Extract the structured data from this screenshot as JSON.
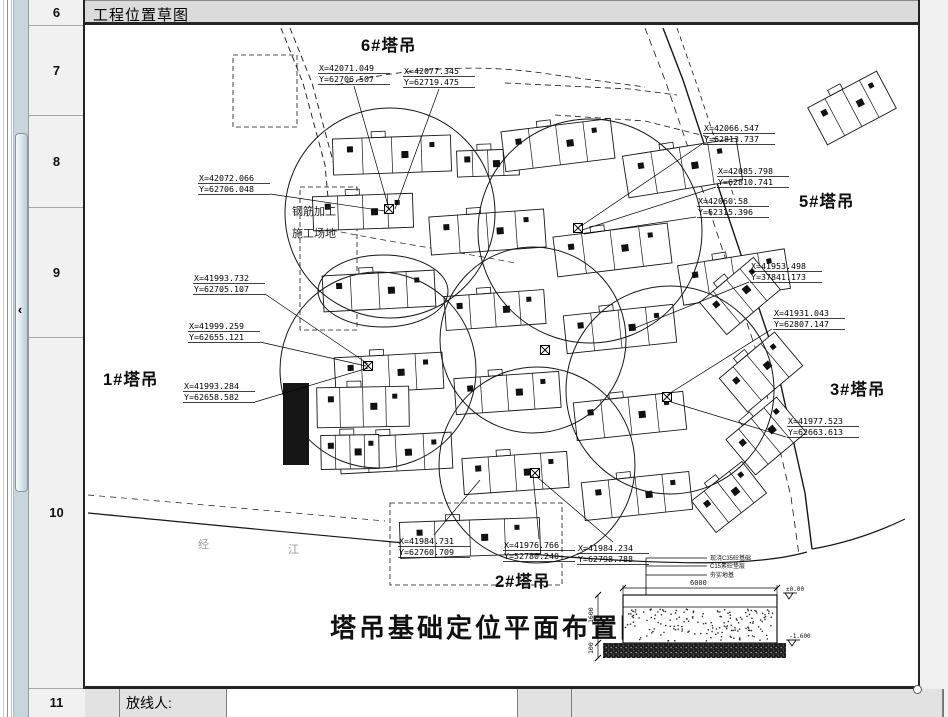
{
  "title_bar": {
    "title": "工程位置草图"
  },
  "row_headers": [
    "6",
    "7",
    "8",
    "9",
    "10",
    "11"
  ],
  "bottom_row": {
    "label": "放线人:"
  },
  "plan": {
    "title": "塔吊基础定位平面布置图",
    "cranes": [
      {
        "name": "6#塔吊",
        "x": 276,
        "y": 26
      },
      {
        "name": "5#塔吊",
        "x": 714,
        "y": 182
      },
      {
        "name": "1#塔吊",
        "x": 18,
        "y": 360
      },
      {
        "name": "3#塔吊",
        "x": 745,
        "y": 370
      },
      {
        "name": "2#塔吊",
        "x": 410,
        "y": 562
      }
    ],
    "callouts": [
      {
        "x": 233,
        "y": 38,
        "l1": "X=42071.049",
        "l2": "Y=62706.507",
        "side": "d",
        "tx": 304,
        "ty": 184
      },
      {
        "x": 318,
        "y": 41,
        "l1": "X=42077.345",
        "l2": "Y=62719.475",
        "side": "d",
        "tx": 310,
        "ty": 184
      },
      {
        "x": 113,
        "y": 148,
        "l1": "X=42072.066",
        "l2": "Y=62706.048",
        "side": "r",
        "tx": 300,
        "ty": 186
      },
      {
        "x": 618,
        "y": 98,
        "l1": "X=42066.547",
        "l2": "Y=62813.737",
        "side": "l",
        "tx": 496,
        "ty": 201
      },
      {
        "x": 632,
        "y": 141,
        "l1": "X=42085.798",
        "l2": "Y=62810.741",
        "side": "l",
        "tx": 497,
        "ty": 205
      },
      {
        "x": 612,
        "y": 171,
        "l1": "X=42060.58",
        "l2": "Y=62315.396",
        "side": "l",
        "tx": 499,
        "ty": 209
      },
      {
        "x": 665,
        "y": 236,
        "l1": "X=41953.498",
        "l2": "Y=37841.173",
        "side": "l",
        "tx": 545,
        "ty": 305
      },
      {
        "x": 688,
        "y": 283,
        "l1": "X=41931.043",
        "l2": "Y=62807.147",
        "side": "l",
        "tx": 582,
        "ty": 370
      },
      {
        "x": 702,
        "y": 391,
        "l1": "X=41977.523",
        "l2": "Y=62663.613",
        "side": "l",
        "tx": 586,
        "ty": 377
      },
      {
        "x": 108,
        "y": 248,
        "l1": "X=41993.732",
        "l2": "Y=62705.107",
        "side": "r",
        "tx": 283,
        "ty": 339
      },
      {
        "x": 103,
        "y": 296,
        "l1": "X=41999.259",
        "l2": "Y=62655.121",
        "side": "r",
        "tx": 281,
        "ty": 341
      },
      {
        "x": 98,
        "y": 356,
        "l1": "X=41993.284",
        "l2": "Y=62658.582",
        "side": "r",
        "tx": 283,
        "ty": 343
      },
      {
        "x": 313,
        "y": 511,
        "l1": "X=41984.731",
        "l2": "Y=62760.709",
        "side": "u",
        "tx": 395,
        "ty": 455
      },
      {
        "x": 418,
        "y": 515,
        "l1": "X=41976.766",
        "l2": "Y=52780.240",
        "side": "u",
        "tx": 448,
        "ty": 450
      },
      {
        "x": 492,
        "y": 518,
        "l1": "X=41984.234",
        "l2": "Y=62798.788",
        "side": "u",
        "tx": 452,
        "ty": 452
      }
    ],
    "yard": {
      "x": 207,
      "y": 190,
      "line1": "钢筋加工",
      "line2": "施工场地"
    },
    "road_chars": [
      {
        "ch": "经",
        "x": 113,
        "y": 523
      },
      {
        "ch": "江",
        "x": 203,
        "y": 528
      }
    ],
    "detail": {
      "notes": [
        "现浇C35砼基础",
        "C15素砼垫层",
        "夯实地基"
      ],
      "dim_top": "6000",
      "dim_left": "1600",
      "dim_base": "100",
      "level_top": "±0.00",
      "level_bot": "-1.600"
    }
  },
  "geometry": {
    "circles": [
      [
        305,
        188,
        105
      ],
      [
        505,
        206,
        112
      ],
      [
        448,
        315,
        93
      ],
      [
        293,
        345,
        98
      ],
      [
        585,
        365,
        104
      ],
      [
        452,
        440,
        98
      ]
    ],
    "ellipse": [
      298,
      266,
      65,
      36
    ],
    "markers": [
      [
        304,
        184
      ],
      [
        493,
        203
      ],
      [
        283,
        341
      ],
      [
        582,
        372
      ],
      [
        450,
        448
      ],
      [
        460,
        325
      ]
    ],
    "buildings": [
      [
        248,
        112,
        118,
        36,
        -2
      ],
      [
        372,
        125,
        62,
        26,
        -2
      ],
      [
        418,
        100,
        110,
        40,
        -7
      ],
      [
        540,
        122,
        115,
        42,
        -9
      ],
      [
        228,
        170,
        100,
        34,
        -2
      ],
      [
        345,
        188,
        115,
        38,
        -4
      ],
      [
        470,
        205,
        115,
        40,
        -7
      ],
      [
        595,
        232,
        108,
        40,
        -9
      ],
      [
        238,
        248,
        112,
        36,
        -3
      ],
      [
        360,
        268,
        100,
        34,
        -4
      ],
      [
        480,
        285,
        110,
        38,
        -6
      ],
      [
        250,
        330,
        108,
        36,
        -3
      ],
      [
        370,
        350,
        105,
        36,
        -4
      ],
      [
        490,
        372,
        110,
        38,
        -6
      ],
      [
        255,
        410,
        112,
        36,
        -3
      ],
      [
        378,
        430,
        105,
        36,
        -4
      ],
      [
        498,
        452,
        108,
        38,
        -6
      ],
      [
        315,
        495,
        140,
        36,
        -2
      ],
      [
        728,
        62,
        78,
        42,
        -28
      ],
      [
        620,
        250,
        70,
        42,
        -40
      ],
      [
        640,
        325,
        72,
        44,
        -40
      ],
      [
        648,
        388,
        66,
        46,
        -40
      ],
      [
        612,
        452,
        64,
        40,
        -38
      ],
      [
        232,
        362,
        92,
        40,
        -1
      ],
      [
        236,
        410,
        58,
        34,
        -1
      ]
    ],
    "filled_building": [
      198,
      358,
      26,
      82
    ],
    "dashed_rects": [
      [
        215,
        162,
        57,
        143
      ],
      [
        305,
        478,
        172,
        82
      ],
      [
        148,
        30,
        64,
        72
      ]
    ],
    "roads": [
      {
        "d": "M578,3 L598,55 L636,170 L688,325 L720,468 L727,524",
        "dash": "",
        "w": 1.4
      },
      {
        "d": "M560,3 L580,55 L620,172 L672,328 L706,472 L714,530",
        "dash": "7,5",
        "w": 0.8
      },
      {
        "d": "M592,3 L612,60 L650,175",
        "dash": "5,4",
        "w": 0.8
      },
      {
        "d": "M3,488 C150,502 330,520 470,531 C600,541 676,540 722,527",
        "dash": "",
        "w": 1.2
      },
      {
        "d": "M3,470 C110,479 210,488 300,496",
        "dash": "6,5",
        "w": 0.7
      },
      {
        "d": "M727,524 C762,518 795,506 820,494",
        "dash": "",
        "w": 1.2
      },
      {
        "d": "M196,3 L218,58 L240,140 L246,205",
        "dash": "6,4",
        "w": 0.9
      },
      {
        "d": "M205,3 L227,58 L249,140",
        "dash": "6,4",
        "w": 0.9
      },
      {
        "d": "M252,60 C320,42 400,38 470,50 L560,62",
        "dash": "6,4",
        "w": 0.8
      },
      {
        "d": "M420,58 L545,64 L592,70",
        "dash": "6,4",
        "w": 0.8
      },
      {
        "d": "M470,90 L560,96 L640,116",
        "dash": "6,4",
        "w": 0.8
      },
      {
        "d": "M246,205 C310,218 380,228 430,238",
        "dash": "6,4",
        "w": 0.7
      }
    ]
  }
}
